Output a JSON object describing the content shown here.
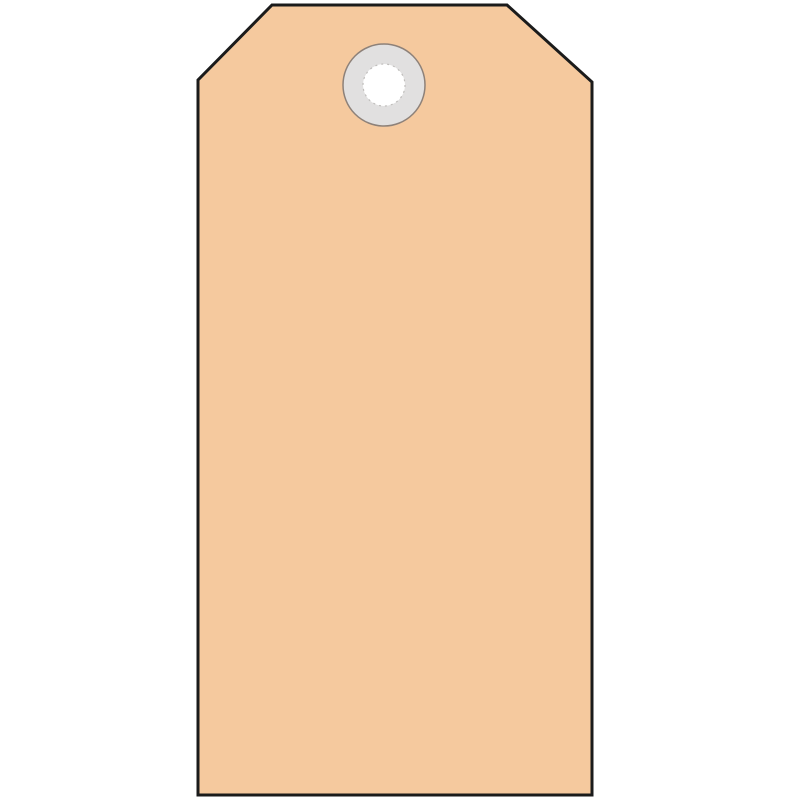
{
  "image": {
    "subject": "blank manila shipping tag with reinforced eyelet",
    "background_color": "#ffffff"
  },
  "tag": {
    "fill": "#f5c99e",
    "border_color": "#1b1b1b",
    "border_width": "3",
    "eyelet": {
      "ring_fill": "#e1e0e0",
      "ring_border": "#8d8179",
      "ring_border_width": "1.5",
      "hole_fill": "#ffffff",
      "hole_rim_color": "#bfbdbb"
    }
  }
}
